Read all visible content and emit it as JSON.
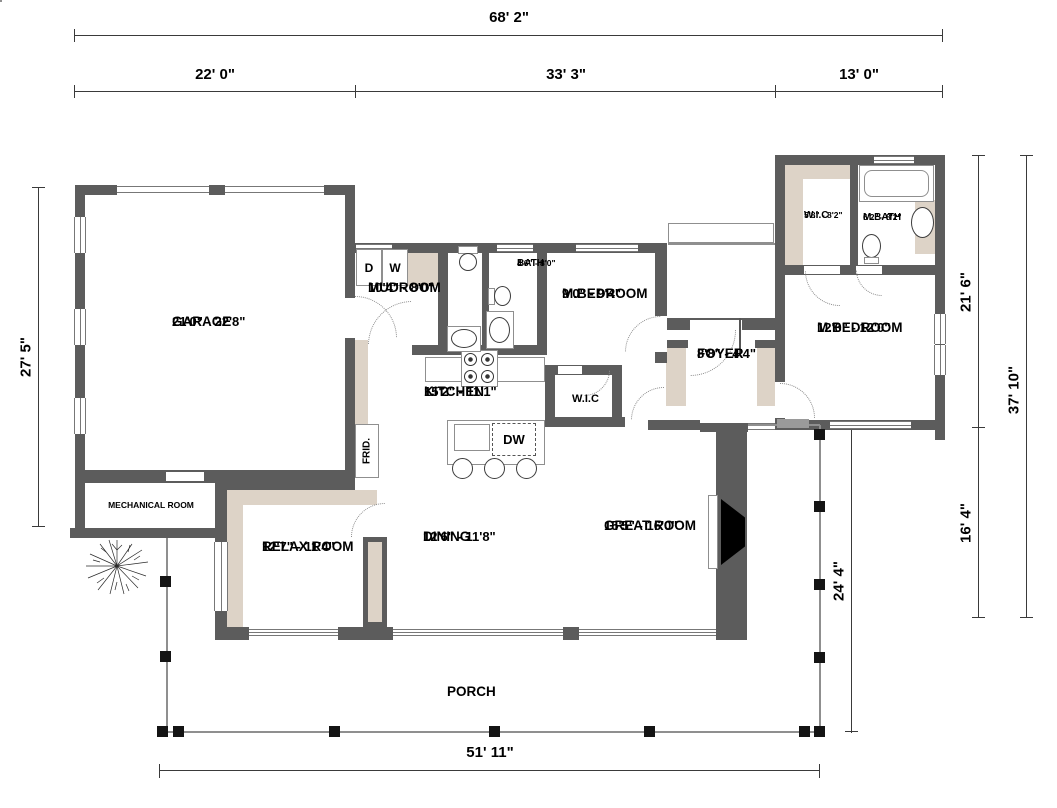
{
  "dimensions": {
    "overall_width": "68' 2\"",
    "seg_garage": "22' 0\"",
    "seg_mid": "33' 3\"",
    "seg_right": "13' 0\"",
    "left_height": "27' 5\"",
    "right_upper": "21' 6\"",
    "right_lower": "16' 4\"",
    "right_total": "37' 10\"",
    "porch_depth": "24' 4\"",
    "porch_width": "51' 11\""
  },
  "rooms": {
    "garage": {
      "name": "GARAGE",
      "size": "21'0\" - 22'8\""
    },
    "mudroom": {
      "name": "MUDROOM",
      "size": "10'4\" - 8'0\""
    },
    "bath": {
      "name": "BATH",
      "size": "4'6\" - 8'0\""
    },
    "mbedroom1": {
      "name": "M.BEDROOM",
      "size": "9'0\" - 9'4\""
    },
    "wic_upper": {
      "name": "W.I.C",
      "size": "5'8\" - 8'2\""
    },
    "mbath": {
      "name": "M.BATH",
      "size": "6'2\" - 8'2\""
    },
    "mbedroom2": {
      "name": "M.BEDROOM",
      "size": "12'0\" - 12'0\""
    },
    "foyer": {
      "name": "FOYER",
      "size": "8'8\" - 4'4\""
    },
    "kitchen": {
      "name": "KITCHEN",
      "size": "15'2\" - 11'1\""
    },
    "wic_hall": {
      "name": "W.I.C"
    },
    "mechanical": {
      "name": "MECHANICAL ROOM"
    },
    "relax": {
      "name": "RELAX ROOM",
      "size": "12'7\" - 11'4\""
    },
    "dining": {
      "name": "DINING",
      "size": "12'6\" - 11'8\""
    },
    "great": {
      "name": "GREAT ROOM",
      "size": "15'5\" - 16'0\""
    },
    "porch": {
      "name": "PORCH"
    }
  },
  "appliances": {
    "dryer": "D",
    "washer": "W",
    "dishwasher": "DW",
    "fridge": "FRID."
  },
  "colors": {
    "wall": "#5c5c5c",
    "fill": "#ddd3c7",
    "line": "#8f8f8f",
    "ink": "#000000"
  }
}
